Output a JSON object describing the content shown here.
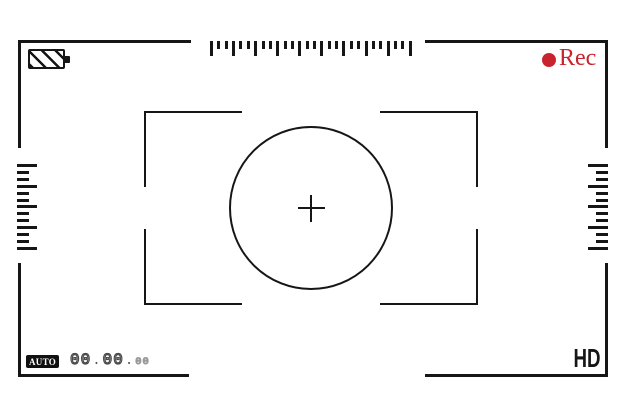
{
  "meta": {
    "screen": "camera-viewfinder"
  },
  "colors": {
    "line": "#161616",
    "rec_red": "#c9242e",
    "timecode_outline": "#4a4a4a",
    "timecode_small_outline": "#999999",
    "badge_bg": "#111111",
    "badge_text": "#ffffff",
    "background": "#ffffff"
  },
  "icons": {
    "battery_icon": "hatched-battery-shape",
    "record_dot_icon": "●",
    "crosshair_icon": "+"
  },
  "status_bar": {
    "rec_label": "Rec"
  },
  "rulers": {
    "top_ticks": [
      15,
      8,
      8,
      15,
      8,
      8,
      15,
      8,
      8,
      15,
      8,
      8,
      15,
      8,
      8,
      15,
      8,
      8,
      15,
      8,
      8,
      15,
      8,
      8,
      15,
      8,
      8,
      15
    ],
    "left_ticks": [
      20,
      12,
      12,
      20,
      12,
      12,
      20,
      12,
      12,
      20,
      12,
      12,
      20
    ],
    "right_ticks": [
      20,
      12,
      12,
      20,
      12,
      12,
      20,
      12,
      12,
      20,
      12,
      12,
      20
    ]
  },
  "bottom_bar": {
    "mode_label": "AUTO",
    "quality_label": "HD",
    "timecode": {
      "full": "00.00.00",
      "hours": "00",
      "minutes": "00",
      "frames": "00",
      "separator": "."
    }
  }
}
